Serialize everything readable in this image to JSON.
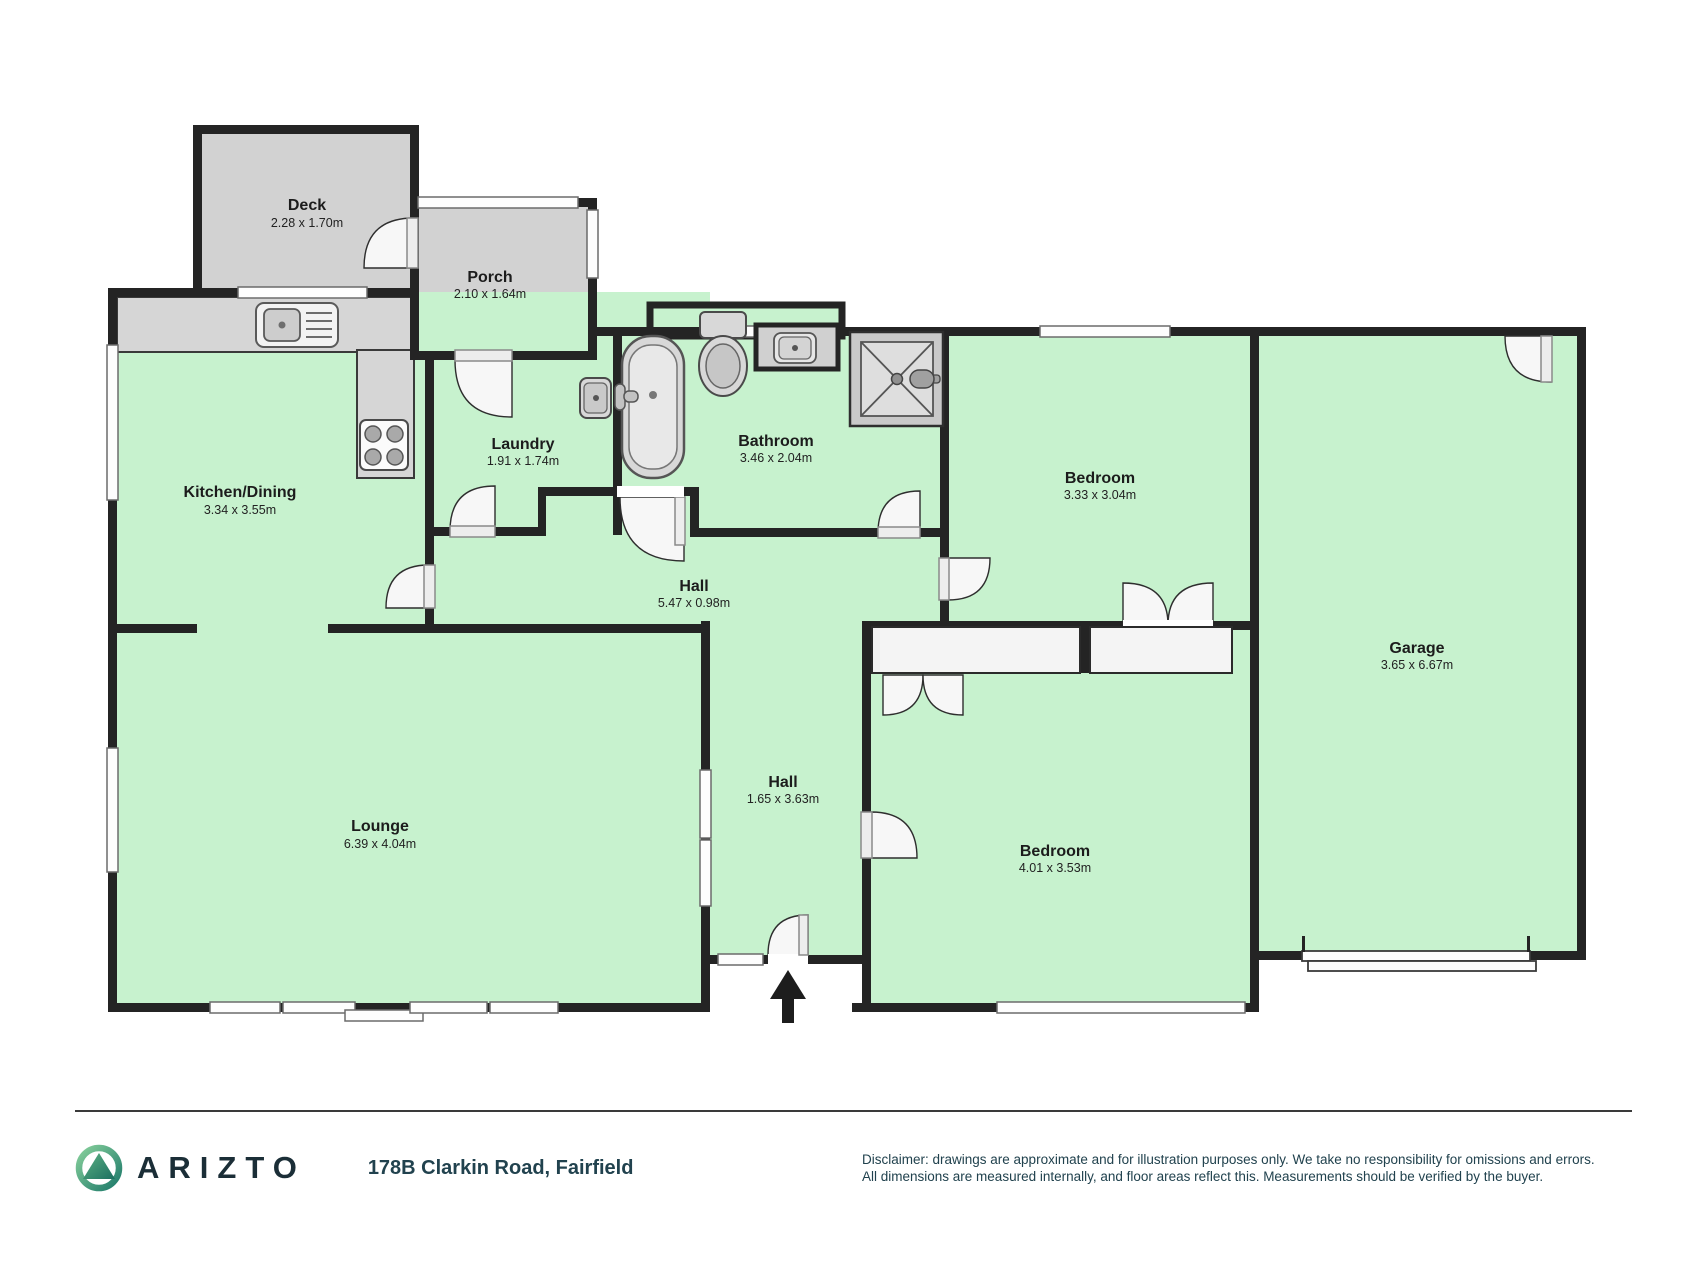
{
  "plan": {
    "rooms": [
      {
        "id": "deck",
        "name": "Deck",
        "dims": "2.28 x 1.70m"
      },
      {
        "id": "porch",
        "name": "Porch",
        "dims": "2.10 x 1.64m"
      },
      {
        "id": "kitchen",
        "name": "Kitchen/Dining",
        "dims": "3.34 x 3.55m"
      },
      {
        "id": "laundry",
        "name": "Laundry",
        "dims": "1.91 x 1.74m"
      },
      {
        "id": "bathroom",
        "name": "Bathroom",
        "dims": "3.46 x 2.04m"
      },
      {
        "id": "hall-upper",
        "name": "Hall",
        "dims": "5.47 x 0.98m"
      },
      {
        "id": "bedroom-1",
        "name": "Bedroom",
        "dims": "3.33 x 3.04m"
      },
      {
        "id": "garage",
        "name": "Garage",
        "dims": "3.65 x 6.67m"
      },
      {
        "id": "hall-lower",
        "name": "Hall",
        "dims": "1.65 x 3.63m"
      },
      {
        "id": "lounge",
        "name": "Lounge",
        "dims": "6.39 x 4.04m"
      },
      {
        "id": "bedroom-2",
        "name": "Bedroom",
        "dims": "4.01 x 3.53m"
      }
    ],
    "colors": {
      "room_fill": "#c7f2ce",
      "outdoor_fill": "#d2d2d2",
      "wall": "#242424",
      "fixture_fill": "#d8d8d8",
      "door_fill": "#f7f7f7"
    }
  },
  "footer": {
    "brand": "ARIZTO",
    "logo_icon": "arizto-mountain-logo",
    "address": "178B Clarkin Road, Fairfield",
    "disclaimer_line1": "Disclaimer: drawings are approximate and for illustration purposes only. We take no responsibility for omissions and errors.",
    "disclaimer_line2": "All dimensions are measured internally, and floor areas reflect this. Measurements should be verified by the buyer.",
    "brand_color": "#1b2e37",
    "logo_green_light": "#86cf9b",
    "logo_green_dark": "#1e7a6a"
  }
}
